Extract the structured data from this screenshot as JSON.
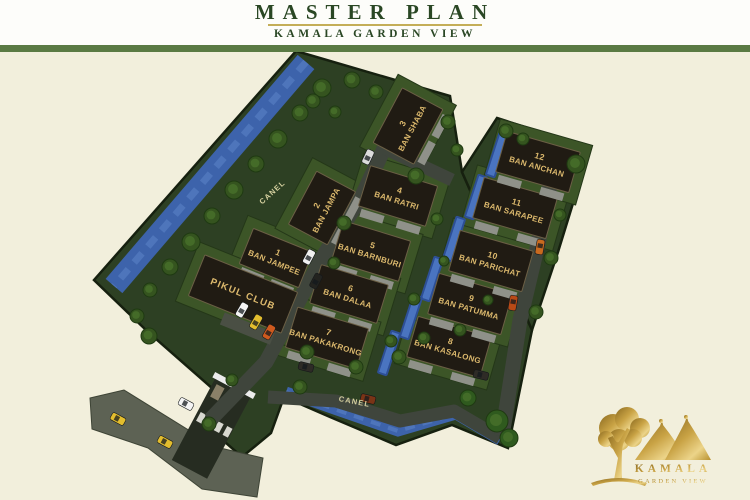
{
  "header": {
    "title": "MASTER PLAN",
    "subtitle": "KAMALA GARDEN VIEW"
  },
  "map": {
    "villas": [
      {
        "number": "1",
        "name": "BAN JAMPEE"
      },
      {
        "number": "2",
        "name": "BAN JAMPA"
      },
      {
        "number": "3",
        "name": "BAN SHABA"
      },
      {
        "number": "4",
        "name": "BAN RATRI"
      },
      {
        "number": "5",
        "name": "BAN BARNBURI"
      },
      {
        "number": "6",
        "name": "BAN DALAA"
      },
      {
        "number": "7",
        "name": "BAN PAKAKRONG"
      },
      {
        "number": "8",
        "name": "BAN KASALONG"
      },
      {
        "number": "9",
        "name": "BAN PATUMMA"
      },
      {
        "number": "10",
        "name": "BAN PARICHAT"
      },
      {
        "number": "11",
        "name": "BAN SARAPEE"
      },
      {
        "number": "12",
        "name": "BAN ANCHAN"
      }
    ],
    "club_label": "PIKUL CLUB",
    "canal_label": "CANEL"
  },
  "logo": {
    "name": "KAMALA",
    "subtitle": "GARDEN VIEW"
  },
  "colors": {
    "header_bar_green": "#5a7a43",
    "page_cream": "#f2efdc",
    "title_green": "#2a4724",
    "underline_gold": "#c4ae58",
    "label_gold": "#dcb96d",
    "canal_text": "#d6d1a0",
    "land_green": "#2d4023",
    "lawn_green": "#3c5527",
    "canal_blue": "#3d63ab",
    "canal_light": "#567dc2",
    "road_gray": "#3f453c",
    "outer_road_gray": "#5d6254",
    "villa_dark": "#201b13",
    "logo_gold": "#c9a345"
  }
}
